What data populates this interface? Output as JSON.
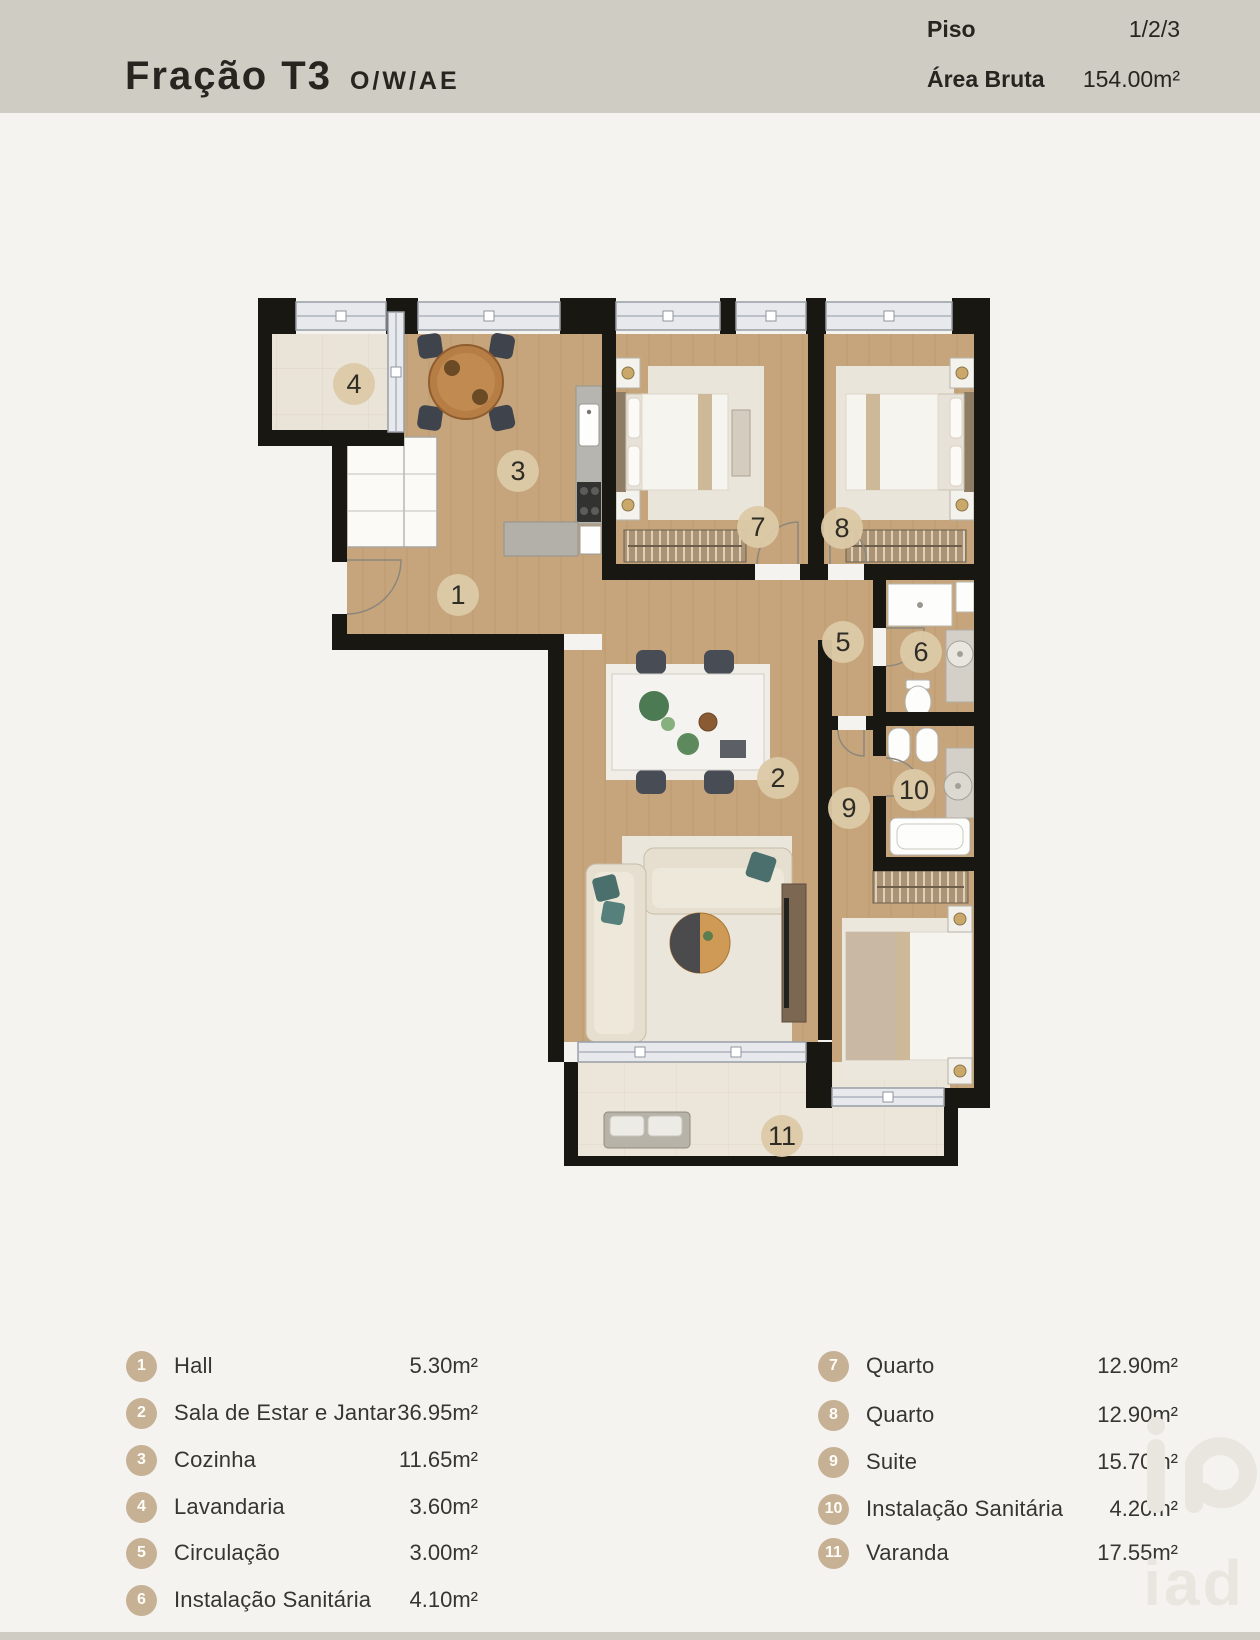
{
  "header": {
    "title": "Fração T3",
    "title_suffix": "O/W/AE",
    "piso_label": "Piso",
    "piso_value": "1/2/3",
    "area_label": "Área Bruta",
    "area_value": "154.00m²"
  },
  "plan": {
    "badges": [
      {
        "number": "1",
        "room": "Hall"
      },
      {
        "number": "2",
        "room": "Sala de Estar e Jantar"
      },
      {
        "number": "3",
        "room": "Cozinha"
      },
      {
        "number": "4",
        "room": "Lavandaria"
      },
      {
        "number": "5",
        "room": "Circulação"
      },
      {
        "number": "6",
        "room": "Instalação Sanitária"
      },
      {
        "number": "7",
        "room": "Quarto"
      },
      {
        "number": "8",
        "room": "Quarto"
      },
      {
        "number": "9",
        "room": "Suite"
      },
      {
        "number": "10",
        "room": "Instalação Sanitária"
      },
      {
        "number": "11",
        "room": "Varanda"
      }
    ]
  },
  "legend": {
    "left": [
      {
        "number": "1",
        "name": "Hall",
        "area": "5.30m²"
      },
      {
        "number": "2",
        "name": "Sala de Estar e Jantar",
        "area": "36.95m²"
      },
      {
        "number": "3",
        "name": "Cozinha",
        "area": "11.65m²"
      },
      {
        "number": "4",
        "name": "Lavandaria",
        "area": "3.60m²"
      },
      {
        "number": "5",
        "name": "Circulação",
        "area": "3.00m²"
      },
      {
        "number": "6",
        "name": "Instalação Sanitária",
        "area": "4.10m²"
      }
    ],
    "right": [
      {
        "number": "7",
        "name": "Quarto",
        "area": "12.90m²"
      },
      {
        "number": "8",
        "name": "Quarto",
        "area": "12.90m²"
      },
      {
        "number": "9",
        "name": "Suite",
        "area": "15.70m²"
      },
      {
        "number": "10",
        "name": "Instalação Sanitária",
        "area": "4.20m²"
      },
      {
        "number": "11",
        "name": "Varanda",
        "area": "17.55m²"
      }
    ]
  },
  "watermark": {
    "text": "iad"
  },
  "colors": {
    "header_bar": "#cfccc3",
    "wall": "#181712",
    "wood_floor": "#c6a57c",
    "tile_floor": "#eae3d7",
    "window_glass": "#e7e9ed",
    "plan_badge": "#dcc9a8",
    "legend_badge": "#c6b195",
    "accent_teal": "#4a6f6c"
  }
}
